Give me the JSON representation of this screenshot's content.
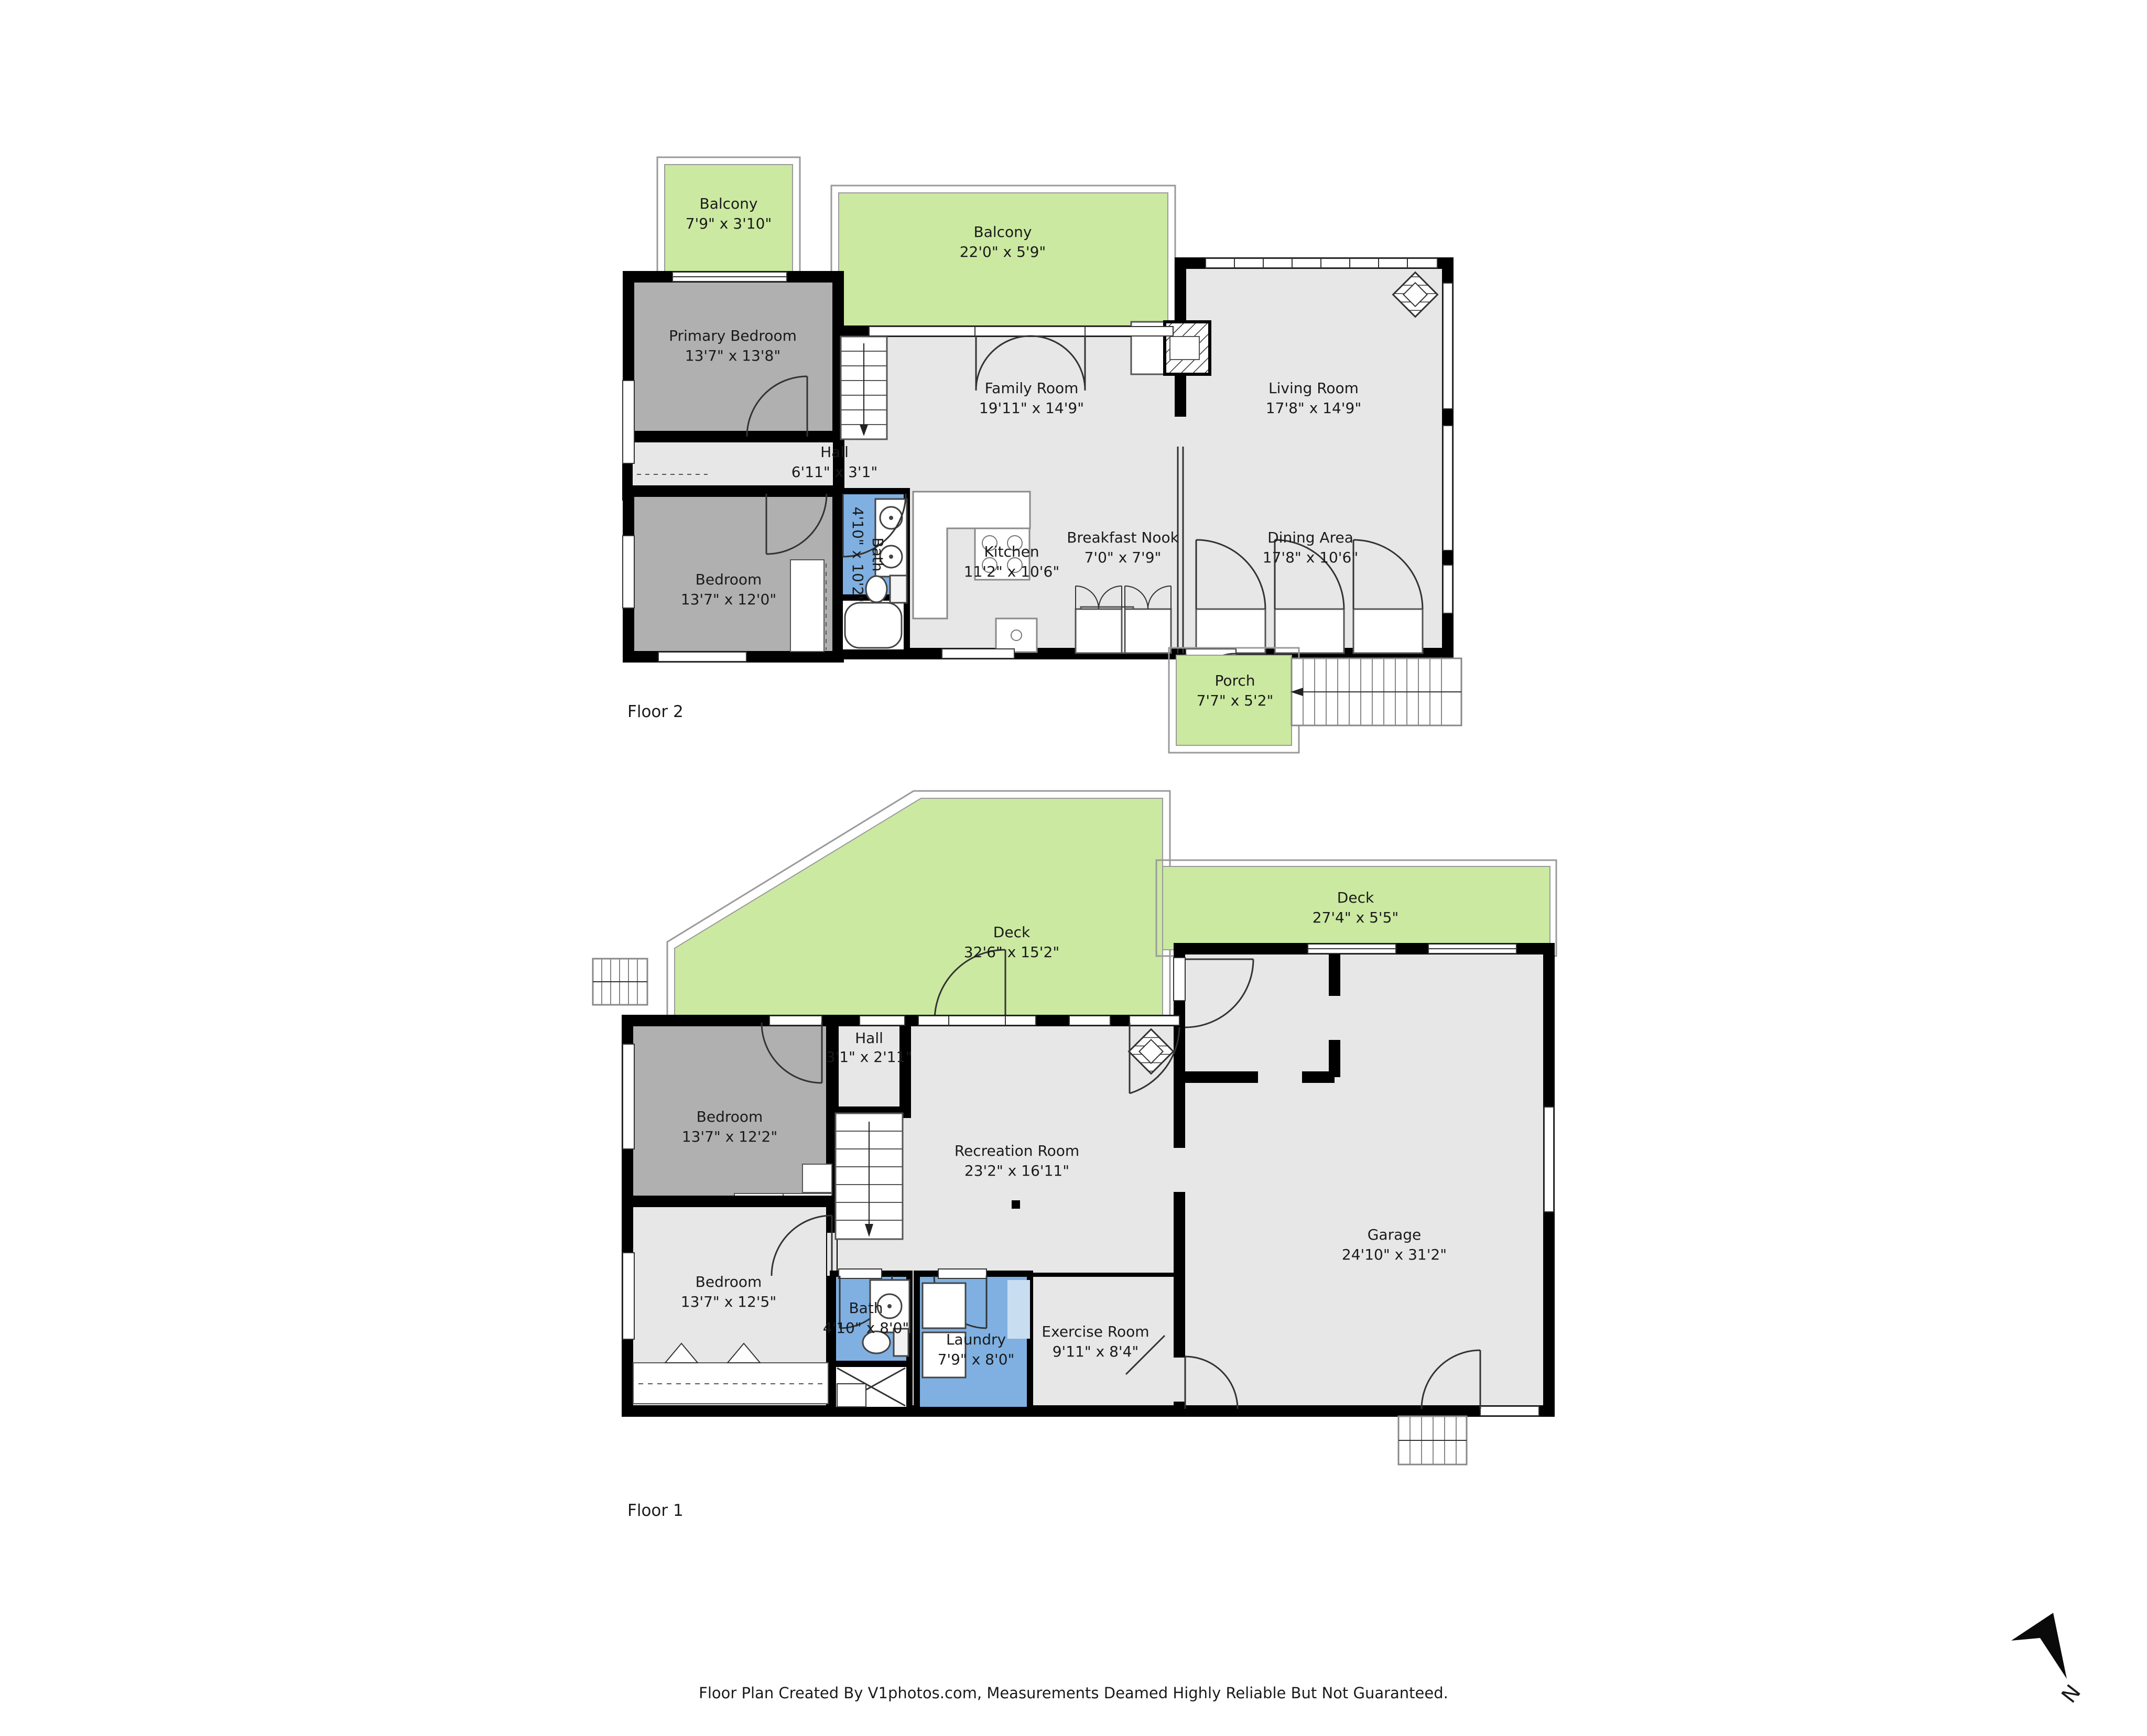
{
  "page": {
    "footer": "Floor Plan Created By V1photos.com, Measurements Deamed Highly Reliable But Not Guaranteed.",
    "north": "N"
  },
  "colors": {
    "wall": "#000000",
    "room_light": "#e7e7e7",
    "room_dark": "#b0b0b0",
    "outdoor_green": "#cbe9a1",
    "bath_blue": "#7fb0e1",
    "counter_blue": "#c9ddf1"
  },
  "floor2": {
    "label": "Floor 2",
    "rooms": [
      {
        "name": "Balcony",
        "dims": "7'9\" x 3'10\""
      },
      {
        "name": "Balcony",
        "dims": "22'0\" x 5'9\""
      },
      {
        "name": "Primary Bedroom",
        "dims": "13'7\" x 13'8\""
      },
      {
        "name": "Family Room",
        "dims": "19'11\" x 14'9\""
      },
      {
        "name": "Living Room",
        "dims": "17'8\" x 14'9\""
      },
      {
        "name": "Hall",
        "dims": "6'11\" x 3'1\""
      },
      {
        "name": "Bath",
        "dims": "4'10\" x 10'2\""
      },
      {
        "name": "Kitchen",
        "dims": "11'2\" x 10'6\""
      },
      {
        "name": "Breakfast Nook",
        "dims": "7'0\" x 7'9\""
      },
      {
        "name": "Dining Area",
        "dims": "17'8\" x 10'6\""
      },
      {
        "name": "Bedroom",
        "dims": "13'7\" x 12'0\""
      },
      {
        "name": "Porch",
        "dims": "7'7\" x 5'2\""
      }
    ]
  },
  "floor1": {
    "label": "Floor 1",
    "rooms": [
      {
        "name": "Deck",
        "dims": "32'6\" x 15'2\""
      },
      {
        "name": "Deck",
        "dims": "27'4\" x 5'5\""
      },
      {
        "name": "Hall",
        "dims": "3'1\" x 2'11\""
      },
      {
        "name": "Bedroom",
        "dims": "13'7\" x 12'2\""
      },
      {
        "name": "Recreation Room",
        "dims": "23'2\" x 16'11\""
      },
      {
        "name": "Garage",
        "dims": "24'10\" x 31'2\""
      },
      {
        "name": "Bedroom",
        "dims": "13'7\" x 12'5\""
      },
      {
        "name": "Bath",
        "dims": "4'10\" x 8'0\""
      },
      {
        "name": "Laundry",
        "dims": "7'9\" x 8'0\""
      },
      {
        "name": "Exercise Room",
        "dims": "9'11\" x 8'4\""
      }
    ]
  }
}
